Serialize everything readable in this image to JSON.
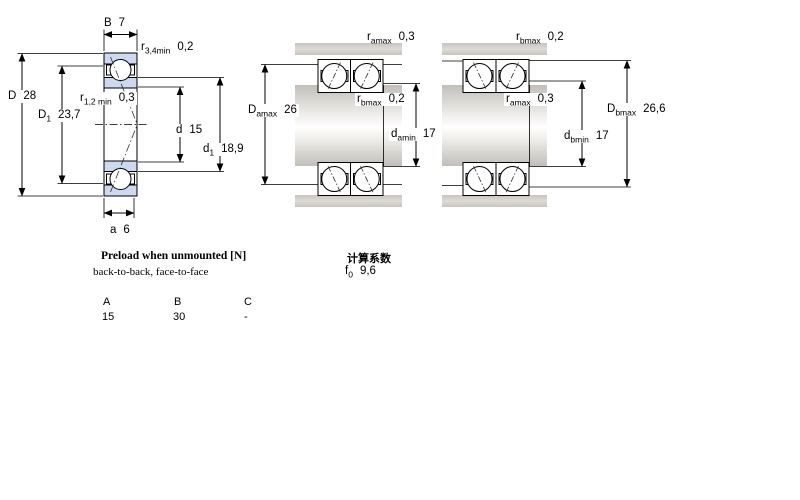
{
  "colors": {
    "bearing_ring_fill": "#ccd9ee",
    "metal_gray": "#d2cfc9",
    "line": "#000000",
    "background": "#ffffff"
  },
  "left_diagram": {
    "description": "bearing cross-section",
    "labels": {
      "B": {
        "sym": "B",
        "sub": "",
        "val": "7"
      },
      "r34": {
        "sym": "r",
        "sub": "3,4min",
        "val": "0,2"
      },
      "D": {
        "sym": "D",
        "sub": "",
        "val": "28"
      },
      "D1": {
        "sym": "D",
        "sub": "1",
        "val": "23,7"
      },
      "r12": {
        "sym": "r",
        "sub": "1,2 min",
        "val": "0,3"
      },
      "d": {
        "sym": "d",
        "sub": "",
        "val": "15"
      },
      "d1": {
        "sym": "d",
        "sub": "1",
        "val": "18,9"
      },
      "a": {
        "sym": "a",
        "sub": "",
        "val": "6"
      }
    }
  },
  "middle_diagram": {
    "description": "mounted bearing pair with abutment dimensions",
    "labels": {
      "ramax": {
        "sym": "r",
        "sub": "amax",
        "val": "0,3"
      },
      "rbmax": {
        "sym": "r",
        "sub": "bmax",
        "val": "0,2"
      },
      "Damax": {
        "sym": "D",
        "sub": "amax",
        "val": "26"
      },
      "damin": {
        "sym": "d",
        "sub": "amin",
        "val": "17"
      }
    }
  },
  "right_diagram": {
    "description": "mounted bearing pair with abutment dimensions",
    "labels": {
      "rbmax": {
        "sym": "r",
        "sub": "bmax",
        "val": "0,2"
      },
      "ramax": {
        "sym": "r",
        "sub": "amax",
        "val": "0,3"
      },
      "Dbmax": {
        "sym": "D",
        "sub": "bmax",
        "val": "26,6"
      },
      "dbmin": {
        "sym": "d",
        "sub": "bmin",
        "val": "17"
      }
    }
  },
  "notes": {
    "preload_title": "Preload when unmounted [N]",
    "preload_subtitle": "back-to-back, face-to-face",
    "calc_title": "计算系数",
    "f0": {
      "sym": "f",
      "sub": "0",
      "val": "9,6"
    }
  },
  "preload_table": {
    "headers": [
      "A",
      "B",
      "C"
    ],
    "values": [
      "15",
      "30",
      "-"
    ]
  }
}
